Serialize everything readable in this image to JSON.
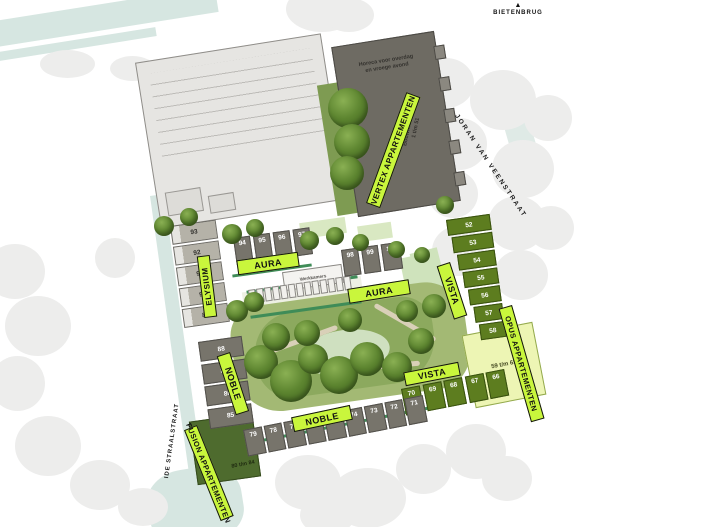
{
  "compass": {
    "arrow": "▲",
    "label": "BIETENBRUG"
  },
  "streets": {
    "right": "JORAN VAN VEENSTRAAT",
    "left": "IDE STRAALSTRAAT"
  },
  "vertex": {
    "label": "VERTEX APPARTEMENTEN",
    "note_line1": "Horeca voor overdag",
    "note_line2": "en vroege avond",
    "bouw_label": "Bouwnummers",
    "bouw_range": "1 t/m 51"
  },
  "elysium": {
    "label": "ELYSIUM",
    "plots": [
      "93",
      "92",
      "91",
      "90",
      "89"
    ]
  },
  "aura": {
    "label": "AURA",
    "row1": [
      "94",
      "95",
      "96",
      "97"
    ],
    "row2": [
      "98",
      "99",
      "100"
    ]
  },
  "vista": {
    "label": "VISTA",
    "col": [
      "52",
      "53",
      "54",
      "55",
      "56",
      "57",
      "58"
    ],
    "row": [
      "70",
      "69",
      "68",
      "67",
      "66"
    ]
  },
  "noble": {
    "label": "NOBLE",
    "col": [
      "88",
      "87",
      "86",
      "85"
    ],
    "row": [
      "79",
      "78",
      "77",
      "76",
      "75",
      "74",
      "73",
      "72",
      "71"
    ]
  },
  "fusion": {
    "label": "FUSION APPARTEMENTEN",
    "range": "80 t/m 84"
  },
  "opus": {
    "label": "OPUS APPARTEMENTEN",
    "range": "59 t/m 65"
  },
  "outbuilding": {
    "label": "Werkkamers"
  },
  "colors": {
    "tag_green": "#c9f63c",
    "dark_green_block": "#5d7d1f",
    "gray_block": "#77746b",
    "light_block": "#b5b2a8",
    "opus_green": "#edf5b4",
    "park_green": "#a3b974",
    "water": "#d6e6e1"
  }
}
